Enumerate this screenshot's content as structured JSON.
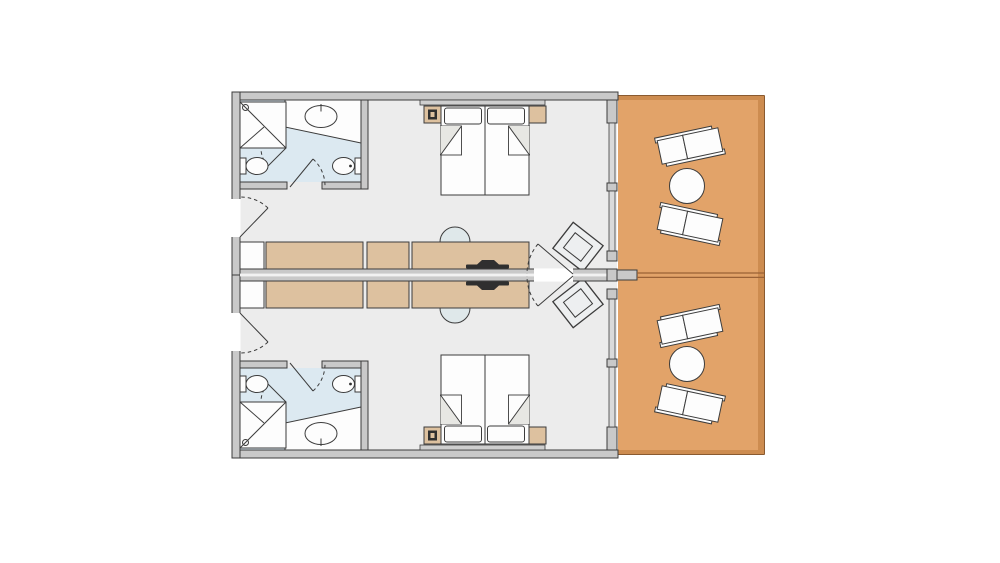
{
  "palette": {
    "background": "#ffffff",
    "room_floor": "#ececec",
    "bathroom_floor": "#dce9f1",
    "furniture_wood": "#ddc19f",
    "terrace_floor": "#e2a369",
    "terrace_edge": "#cd8c50",
    "terrace_border": "#8a5a30",
    "divider_brown": "#9a6136",
    "wall_fill": "#c9c9c9",
    "outline": "#3c3c3c",
    "fixture_white": "#fdfdfd",
    "chair_fill": "#dfe8ea",
    "tv_dark": "#2f2f2f"
  },
  "floor_plan": {
    "type": "twin-unit-floor-plan",
    "units": [
      {
        "id": "unit-a",
        "position": "top",
        "bathroom": [
          "shower-cabin",
          "vanity-counter",
          "round-washbasin",
          "bidet",
          "toilet",
          "bathroom-door"
        ],
        "bedroom": [
          "headboard",
          "nightstand-with-lamp",
          "twin-bed",
          "twin-bed",
          "pillow",
          "pillow",
          "nightstand"
        ],
        "living_area": [
          "entrance-door",
          "minibar",
          "wardrobe-counter",
          "counter-section",
          "desk-counter",
          "desk-chair",
          "tv",
          "armchair",
          "connecting-door"
        ],
        "terrace": [
          "sun-lounger",
          "round-table",
          "sun-lounger"
        ]
      },
      {
        "id": "unit-b",
        "position": "bottom",
        "mirror_of": "unit-a"
      }
    ],
    "shared": [
      "party-wall",
      "connecting-door-pair",
      "terrace-divider"
    ]
  }
}
